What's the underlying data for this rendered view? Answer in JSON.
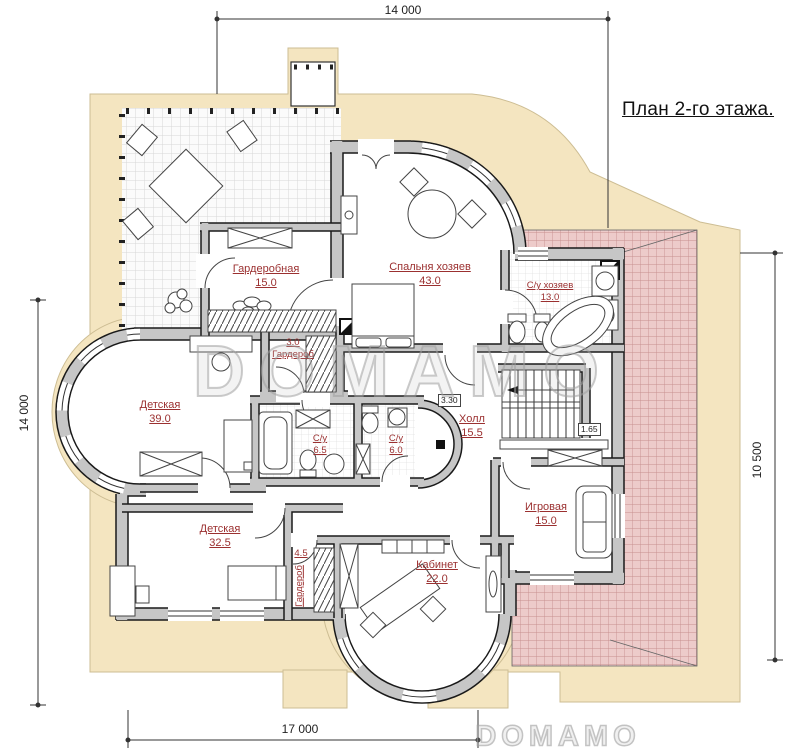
{
  "title": "План 2-го этажа.",
  "rooms": [
    {
      "name": "Гардеробная",
      "area": "15.0"
    },
    {
      "name": "Спальня хозяев",
      "area": "43.0"
    },
    {
      "name": "С/у хозяев",
      "area": "13.0"
    },
    {
      "name": "Гардероб",
      "area": "3.0"
    },
    {
      "name": "Детская",
      "area": "39.0"
    },
    {
      "name": "С/у",
      "area": "6.5"
    },
    {
      "name": "С/у",
      "area": "6.0"
    },
    {
      "name": "Холл",
      "area": "15.5"
    },
    {
      "name": "Игровая",
      "area": "15.0"
    },
    {
      "name": "Детская",
      "area": "32.5"
    },
    {
      "name": "Гардероб",
      "area": "4.5"
    },
    {
      "name": "Кабинет",
      "area": "22.0"
    }
  ],
  "dimensions": {
    "top": "14 000",
    "left": "14 000",
    "right": "10 500",
    "bottom": "17 000"
  },
  "elevation_marks": {
    "upper": "3.30",
    "lower": "1.65"
  },
  "watermark": {
    "center": "DOMAMO",
    "corner": "DOMAMO"
  },
  "colors": {
    "ground": "#f4e5c0",
    "roof": "#edcbca",
    "roof_grid": "#c78f8f",
    "wall": "#c6c6c6",
    "wall_edge": "#1a1a1a",
    "label": "#9b3030",
    "line": "#333333"
  }
}
